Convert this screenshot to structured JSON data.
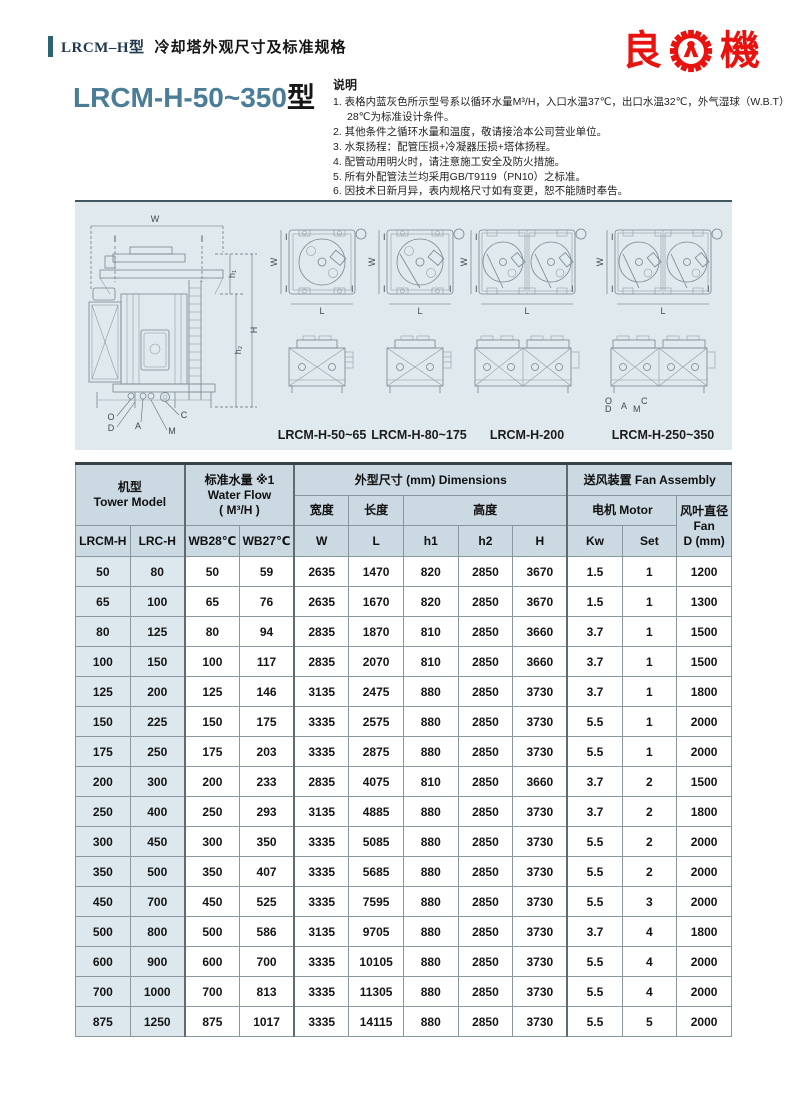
{
  "header": {
    "model_tag": "LRCM–H型",
    "subtitle": "冷却塔外观尺寸及标准规格"
  },
  "logo": {
    "left_char": "良",
    "right_char": "機",
    "gear_icon": "gear-icon",
    "brand_color": "#e8120e"
  },
  "title": {
    "main": "LRCM-H-50~350",
    "suffix": "型"
  },
  "notes": {
    "title": "说明",
    "items": [
      "1. 表格内蓝灰色所示型号系以循环水量M³/H，入口水温37℃，出口水温32℃，外气湿球（W.B.T）28℃为标准设计条件。",
      "2. 其他条件之循环水量和温度，敬请接洽本公司营业单位。",
      "3. 水泵扬程：配管压损+冷凝器压损+塔体扬程。",
      "4. 配管动用明火时，请注意施工安全及防火措施。",
      "5. 所有外配管法兰均采用GB/T9119（PN10）之标准。",
      "6. 因技术日新月异，表内规格尺寸如有变更，恕不能随时奉告。"
    ]
  },
  "drawings": {
    "panel_bg": "#e0e9ed",
    "captions": [
      "LRCM-H-50~65",
      "LRCM-H-80~175",
      "LRCM-H-200",
      "LRCM-H-250~350"
    ],
    "dims": {
      "W": "W",
      "I": "I",
      "h1": "h₁",
      "h2": "h₂",
      "H": "H",
      "L": "L"
    },
    "callouts": {
      "O": "O",
      "D": "D",
      "A": "A",
      "C": "C",
      "M": "M"
    }
  },
  "table": {
    "groups": {
      "model_zh": "机型",
      "model_en": "Tower Model",
      "flow_zh": "标准水量 ※1",
      "flow_en": "Water Flow",
      "flow_unit": "( M³/H )",
      "dimensions": "外型尺寸 (mm) Dimensions",
      "fan": "送风装置 Fan Assembly"
    },
    "subheads": {
      "width": "宽度",
      "length": "长度",
      "height": "高度",
      "motor": "电机 Motor",
      "fan_dia_zh": "风叶直径",
      "fan_dia_en": "Fan",
      "fan_dia_unit": "D (mm)"
    },
    "cols": [
      "LRCM-H",
      "LRC-H",
      "WB28℃",
      "WB27℃",
      "W",
      "L",
      "h1",
      "h2",
      "H",
      "Kw",
      "Set"
    ],
    "rows": [
      [
        "50",
        "80",
        "50",
        "59",
        "2635",
        "1470",
        "820",
        "2850",
        "3670",
        "1.5",
        "1",
        "1200"
      ],
      [
        "65",
        "100",
        "65",
        "76",
        "2635",
        "1670",
        "820",
        "2850",
        "3670",
        "1.5",
        "1",
        "1300"
      ],
      [
        "80",
        "125",
        "80",
        "94",
        "2835",
        "1870",
        "810",
        "2850",
        "3660",
        "3.7",
        "1",
        "1500"
      ],
      [
        "100",
        "150",
        "100",
        "117",
        "2835",
        "2070",
        "810",
        "2850",
        "3660",
        "3.7",
        "1",
        "1500"
      ],
      [
        "125",
        "200",
        "125",
        "146",
        "3135",
        "2475",
        "880",
        "2850",
        "3730",
        "3.7",
        "1",
        "1800"
      ],
      [
        "150",
        "225",
        "150",
        "175",
        "3335",
        "2575",
        "880",
        "2850",
        "3730",
        "5.5",
        "1",
        "2000"
      ],
      [
        "175",
        "250",
        "175",
        "203",
        "3335",
        "2875",
        "880",
        "2850",
        "3730",
        "5.5",
        "1",
        "2000"
      ],
      [
        "200",
        "300",
        "200",
        "233",
        "2835",
        "4075",
        "810",
        "2850",
        "3660",
        "3.7",
        "2",
        "1500"
      ],
      [
        "250",
        "400",
        "250",
        "293",
        "3135",
        "4885",
        "880",
        "2850",
        "3730",
        "3.7",
        "2",
        "1800"
      ],
      [
        "300",
        "450",
        "300",
        "350",
        "3335",
        "5085",
        "880",
        "2850",
        "3730",
        "5.5",
        "2",
        "2000"
      ],
      [
        "350",
        "500",
        "350",
        "407",
        "3335",
        "5685",
        "880",
        "2850",
        "3730",
        "5.5",
        "2",
        "2000"
      ],
      [
        "450",
        "700",
        "450",
        "525",
        "3335",
        "7595",
        "880",
        "2850",
        "3730",
        "5.5",
        "3",
        "2000"
      ],
      [
        "500",
        "800",
        "500",
        "586",
        "3135",
        "9705",
        "880",
        "2850",
        "3730",
        "3.7",
        "4",
        "1800"
      ],
      [
        "600",
        "900",
        "600",
        "700",
        "3335",
        "10105",
        "880",
        "2850",
        "3730",
        "5.5",
        "4",
        "2000"
      ],
      [
        "700",
        "1000",
        "700",
        "813",
        "3335",
        "11305",
        "880",
        "2850",
        "3730",
        "5.5",
        "4",
        "2000"
      ],
      [
        "875",
        "1250",
        "875",
        "1017",
        "3335",
        "14115",
        "880",
        "2850",
        "3730",
        "5.5",
        "5",
        "2000"
      ]
    ],
    "colors": {
      "header_bg": "#cbd9e2",
      "model_col_bg": "#dce8ee",
      "accent_teal": "#2a6372",
      "title_blue": "#4c7d97"
    }
  }
}
